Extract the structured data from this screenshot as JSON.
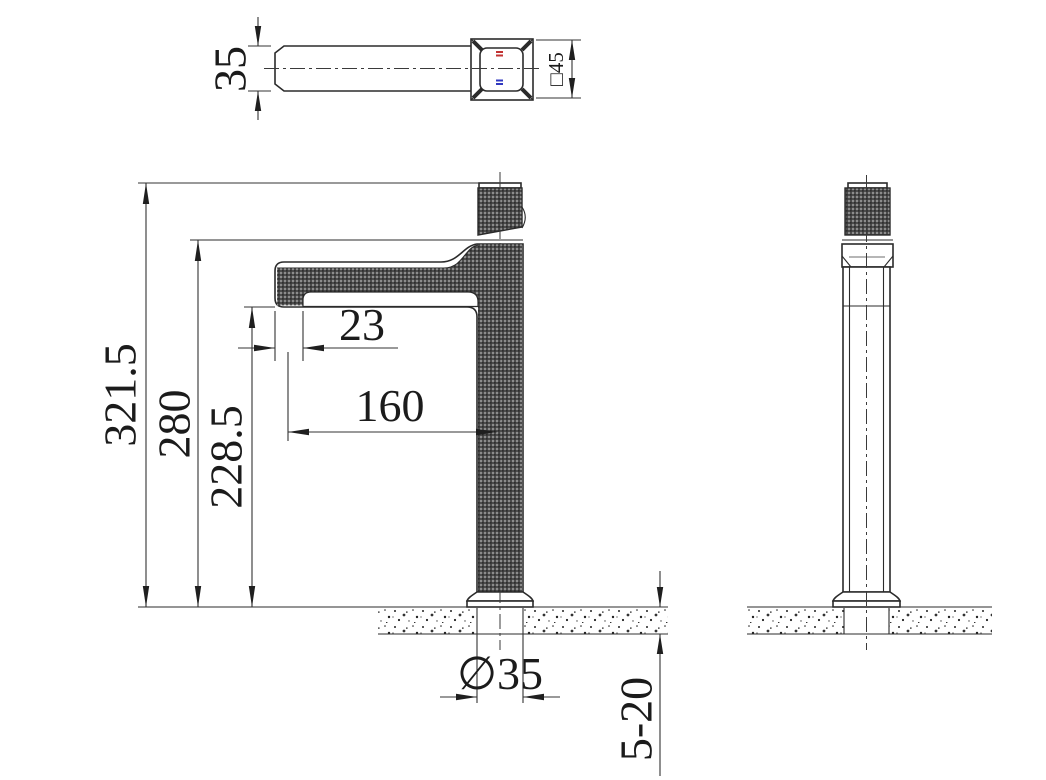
{
  "dimensions": {
    "top_view": {
      "tube_width": "35",
      "handle_square": "□45"
    },
    "front_view": {
      "total_height": "321.5",
      "spout_top_height": "280",
      "outlet_height": "228.5",
      "outlet_width": "23",
      "spout_reach": "160",
      "base_diameter": "∅35",
      "deck_thickness_range": "5-20"
    }
  },
  "colors": {
    "line": "#2b2b2b",
    "text": "#1b1b1b",
    "knurl_base": "#4c4c4c",
    "knurl_light": "#ffffff",
    "knurl_dark": "#0d0d0d",
    "hot_indicator": "#c23232",
    "cold_indicator": "#3038c0"
  }
}
